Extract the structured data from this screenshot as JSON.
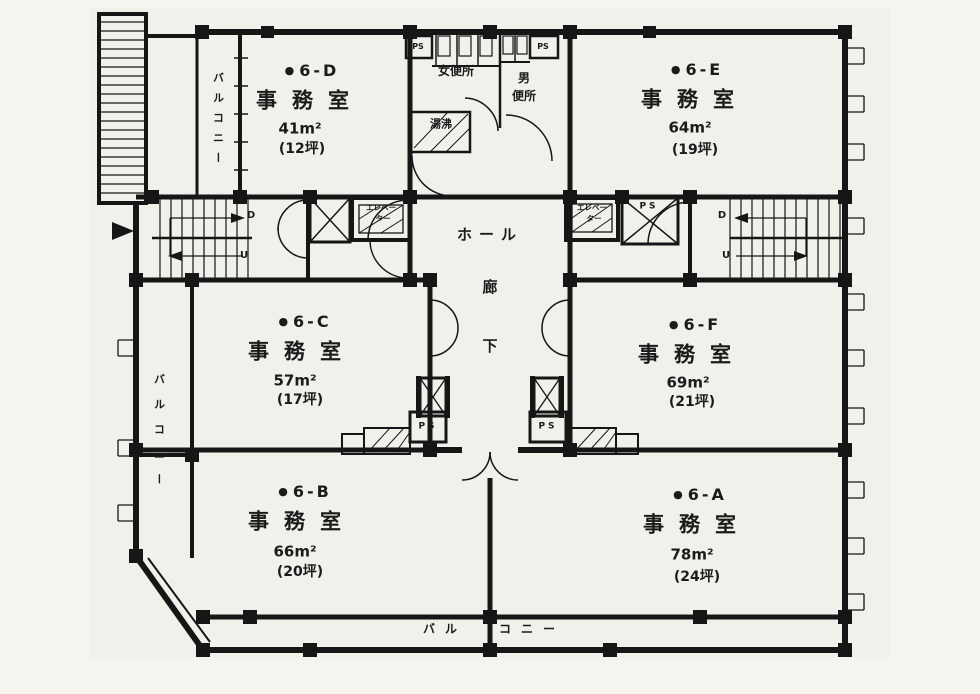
{
  "rooms": [
    {
      "label": "6-D",
      "type": "事務室",
      "area": "41m²",
      "tsubo": "(12坪)"
    },
    {
      "label": "6-E",
      "type": "事務室",
      "area": "64m²",
      "tsubo": "(19坪)"
    },
    {
      "label": "6-C",
      "type": "事務室",
      "area": "57m²",
      "tsubo": "(17坪)"
    },
    {
      "label": "6-F",
      "type": "事務室",
      "area": "69m²",
      "tsubo": "(21坪)"
    },
    {
      "label": "6-B",
      "type": "事務室",
      "area": "66m²",
      "tsubo": "(20坪)"
    },
    {
      "label": "6-A",
      "type": "事務室",
      "area": "78m²",
      "tsubo": "(24坪)"
    }
  ],
  "glyphs": {
    "bullet": "●"
  },
  "core": {
    "hall": "ホール",
    "corridor": "廊下",
    "womens_toilet": "女便所",
    "mens_toilet_line1": "男",
    "mens_toilet_line2": "便所",
    "hot_water": "湯沸",
    "elevator_line1": "エレベー",
    "elevator_line2": "ター",
    "ps": "PS",
    "stair_down": "D",
    "stair_up": "U"
  },
  "balconies": {
    "vertical": "バルコニー",
    "bottom_left": "バル",
    "bottom_right": "コニー"
  }
}
